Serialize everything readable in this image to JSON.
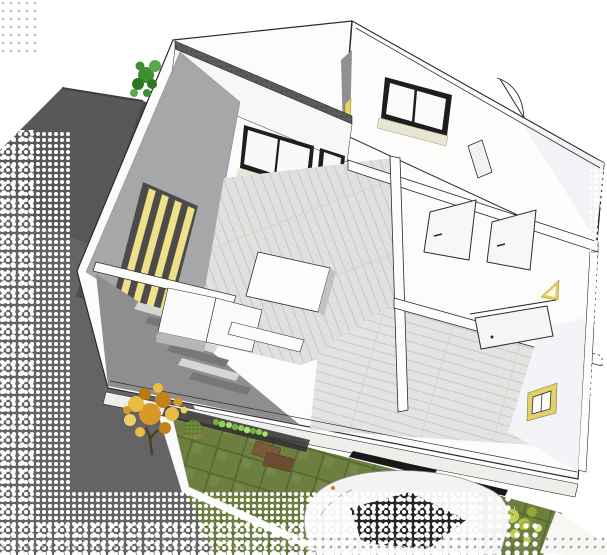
{
  "scene": {
    "kind": "architectural-3d-cutaway-render",
    "view": "aerial-dollhouse-view-of-upper-floor",
    "label": "3D cutaway rendering of a house upper floor with garden, driveway, tree and car",
    "background": "#ffffff"
  },
  "palette": {
    "roof_gray": "#58585a",
    "roof_edge": "#3f3f41",
    "driveway_gray": "#646467",
    "wall_white": "#fcfcfb",
    "wall_face": "#f7f7f5",
    "wall_outline": "#2b2b2d",
    "inner_wall_gray": "#a7a7aa",
    "entry_gray": "#8e8e91",
    "slat_shadow": "#4b4b4e",
    "wood_floor": "#e3e3e1",
    "wood_line": "#c9c9c5",
    "lawn_green": "#6d7f3e",
    "lawn_grid": "#55662f",
    "hedge_green": "#8ed14e",
    "slat_yellow": "#efe18c",
    "frame_yellow": "#e3cf6b",
    "tree_orange": "#d79a28",
    "tree_gold": "#e9bc44",
    "bush_green": "#3f8f35",
    "dry_bush": "#cdd455",
    "planter_brown": "#6b4c30",
    "glass_dark": "#1e1e20",
    "sill_cream": "#e8e6d2",
    "east_face": "#f2f4f8",
    "tread_light": "#d6d6d3",
    "side_gray": "#b7b7ba",
    "car_body": "#f3f3f1",
    "mirror_orange": "#d07a2a"
  },
  "objects": [
    {
      "name": "garage-roof"
    },
    {
      "name": "driveway"
    },
    {
      "name": "house-cutaway"
    },
    {
      "name": "wing-wall"
    },
    {
      "name": "wing-window"
    },
    {
      "name": "sliding-glass-door"
    },
    {
      "name": "louver-slats"
    },
    {
      "name": "staircase"
    },
    {
      "name": "kitchen-island"
    },
    {
      "name": "interior-door"
    },
    {
      "name": "door-swing-arc"
    },
    {
      "name": "picture-frame"
    },
    {
      "name": "lawn-grass-pavers"
    },
    {
      "name": "hedge"
    },
    {
      "name": "autumn-tree"
    },
    {
      "name": "round-shrub"
    },
    {
      "name": "planter-boxes"
    },
    {
      "name": "car"
    },
    {
      "name": "curb-path"
    },
    {
      "name": "halftone-dissolve-edges"
    }
  ]
}
